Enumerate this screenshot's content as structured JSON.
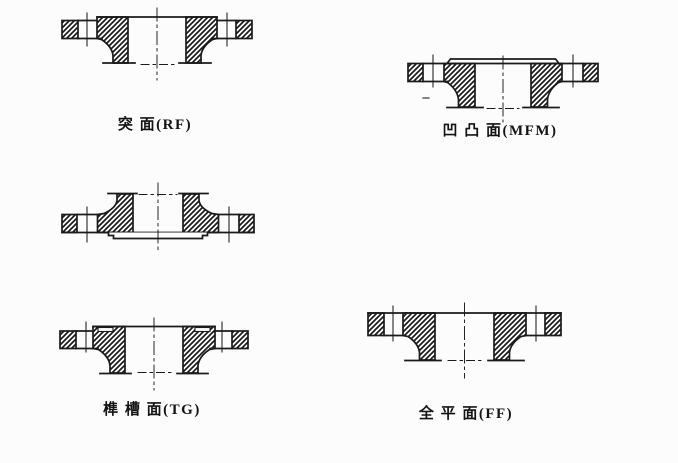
{
  "page": {
    "title": "flange facing types diagram",
    "background": "#fcfcfc",
    "ink_color": "#1b1b1b"
  },
  "figures": {
    "rf": {
      "label": "突 面(RF)"
    },
    "mfm": {
      "label": "凹 凸 面(MFM)"
    },
    "tg": {
      "label": "榫 槽 面(TG)"
    },
    "ff": {
      "label": "全 平 面(FF)"
    }
  }
}
